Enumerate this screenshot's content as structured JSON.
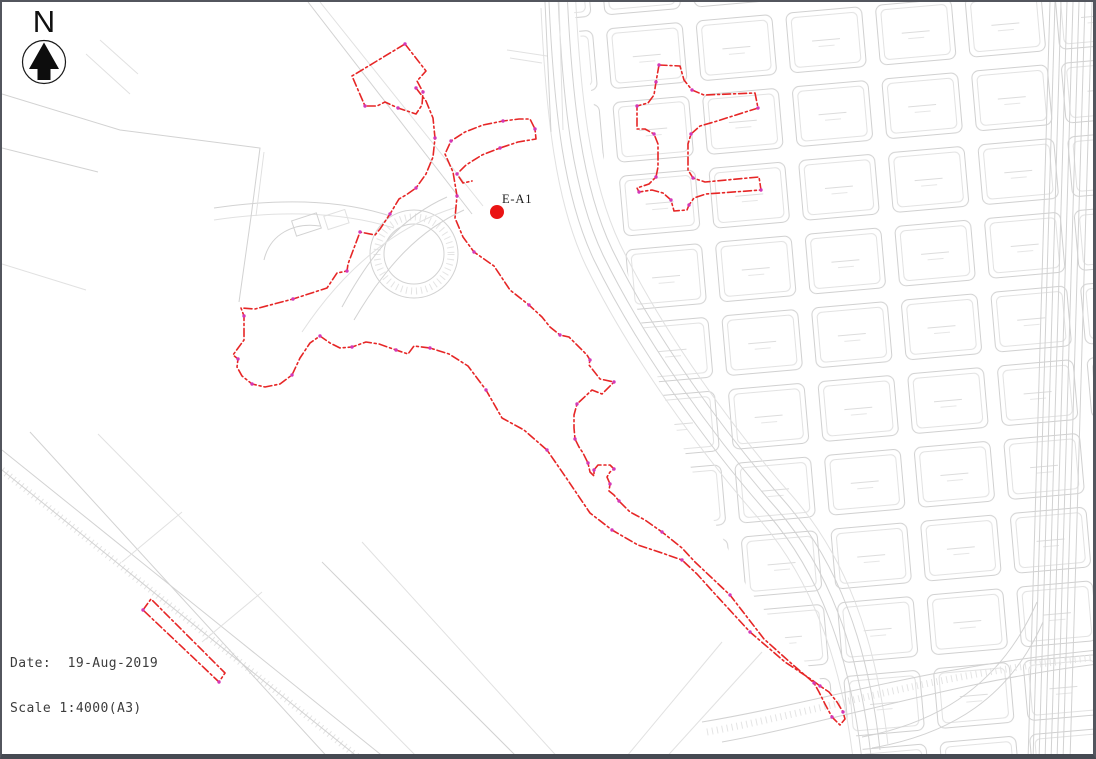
{
  "north_arrow": {
    "label": "N"
  },
  "site_marker": {
    "label": "E-A1",
    "x": 495,
    "y": 210,
    "radius": 7,
    "label_x": 500,
    "label_y": 201
  },
  "title_block": {
    "date_label": "Date:",
    "date_value": "19-Aug-2019",
    "scale_label": "Scale",
    "scale_value": "1:4000(A3)"
  },
  "colors": {
    "boundary_red": "#e62626",
    "node_magenta": "#d338b8",
    "marker_red": "#ea1414",
    "linework_gray": "#d2d2d2",
    "frame_dark": "#4b4f57"
  },
  "boundary": {
    "style": "dash-dot survey boundary with station nodes",
    "shapes": [
      {
        "name": "boundary-north-parcel",
        "closed": true,
        "points": [
          [
            403,
            42
          ],
          [
            424,
            69
          ],
          [
            415,
            79
          ],
          [
            421,
            90
          ],
          [
            420,
            103
          ],
          [
            414,
            112
          ],
          [
            396,
            106
          ],
          [
            383,
            100
          ],
          [
            375,
            104
          ],
          [
            363,
            104
          ],
          [
            350,
            74
          ]
        ]
      },
      {
        "name": "boundary-main-loop",
        "closed": false,
        "points": [
          [
            414,
            86
          ],
          [
            424,
            99
          ],
          [
            431,
            116
          ],
          [
            433,
            136
          ],
          [
            431,
            155
          ],
          [
            424,
            172
          ],
          [
            414,
            186
          ],
          [
            404,
            193
          ],
          [
            397,
            197
          ],
          [
            388,
            212
          ],
          [
            378,
            227
          ],
          [
            373,
            233
          ],
          [
            358,
            230
          ],
          [
            352,
            246
          ],
          [
            346,
            262
          ],
          [
            345,
            269
          ],
          [
            335,
            271
          ],
          [
            325,
            286
          ],
          [
            291,
            297
          ],
          [
            253,
            307
          ],
          [
            239,
            306
          ],
          [
            242,
            314
          ],
          [
            242,
            338
          ],
          [
            231,
            353
          ],
          [
            236,
            357
          ],
          [
            235,
            365
          ],
          [
            240,
            374
          ],
          [
            250,
            382
          ],
          [
            263,
            385
          ],
          [
            278,
            382
          ],
          [
            290,
            373
          ],
          [
            298,
            356
          ],
          [
            308,
            341
          ],
          [
            318,
            334
          ],
          [
            328,
            341
          ],
          [
            338,
            346
          ],
          [
            350,
            345
          ],
          [
            364,
            340
          ],
          [
            377,
            342
          ],
          [
            394,
            348
          ],
          [
            406,
            352
          ],
          [
            412,
            344
          ],
          [
            428,
            346
          ],
          [
            447,
            352
          ],
          [
            466,
            364
          ],
          [
            484,
            388
          ],
          [
            500,
            416
          ],
          [
            522,
            428
          ],
          [
            545,
            448
          ],
          [
            565,
            477
          ],
          [
            588,
            511
          ],
          [
            610,
            528
          ],
          [
            636,
            543
          ],
          [
            660,
            551
          ],
          [
            680,
            558
          ],
          [
            695,
            572
          ],
          [
            713,
            592
          ],
          [
            748,
            630
          ],
          [
            783,
            660
          ],
          [
            810,
            678
          ],
          [
            818,
            684
          ],
          [
            827,
            690
          ],
          [
            835,
            700
          ],
          [
            841,
            710
          ],
          [
            843,
            717
          ],
          [
            838,
            723
          ],
          [
            830,
            715
          ],
          [
            823,
            702
          ],
          [
            817,
            690
          ],
          [
            812,
            681
          ],
          [
            790,
            662
          ],
          [
            762,
            637
          ],
          [
            728,
            593
          ],
          [
            693,
            560
          ],
          [
            680,
            546
          ],
          [
            660,
            530
          ],
          [
            643,
            518
          ],
          [
            628,
            510
          ],
          [
            617,
            499
          ],
          [
            612,
            493
          ],
          [
            607,
            489
          ],
          [
            608,
            482
          ],
          [
            605,
            475
          ],
          [
            608,
            470
          ],
          [
            612,
            467
          ],
          [
            608,
            463
          ],
          [
            596,
            463
          ],
          [
            592,
            468
          ],
          [
            592,
            474
          ],
          [
            588,
            470
          ],
          [
            586,
            461
          ],
          [
            581,
            451
          ],
          [
            577,
            445
          ],
          [
            573,
            437
          ],
          [
            572,
            426
          ],
          [
            572,
            413
          ],
          [
            575,
            402
          ],
          [
            590,
            388
          ],
          [
            600,
            392
          ],
          [
            612,
            380
          ],
          [
            598,
            377
          ],
          [
            587,
            363
          ],
          [
            588,
            358
          ],
          [
            585,
            353
          ],
          [
            567,
            335
          ],
          [
            558,
            333
          ],
          [
            548,
            325
          ],
          [
            540,
            315
          ],
          [
            527,
            303
          ],
          [
            508,
            288
          ],
          [
            492,
            264
          ],
          [
            472,
            250
          ],
          [
            461,
            235
          ],
          [
            453,
            216
          ],
          [
            455,
            194
          ],
          [
            451,
            170
          ],
          [
            443,
            152
          ],
          [
            449,
            139
          ],
          [
            463,
            130
          ],
          [
            481,
            123
          ],
          [
            501,
            119
          ],
          [
            517,
            117
          ],
          [
            528,
            117
          ],
          [
            533,
            127
          ],
          [
            534,
            137
          ],
          [
            516,
            140
          ],
          [
            498,
            146
          ],
          [
            480,
            153
          ],
          [
            464,
            163
          ],
          [
            455,
            172
          ],
          [
            461,
            181
          ],
          [
            470,
            179
          ]
        ]
      },
      {
        "name": "boundary-northeast-cross",
        "closed": true,
        "points": [
          [
            657,
            63
          ],
          [
            678,
            64
          ],
          [
            682,
            78
          ],
          [
            690,
            88
          ],
          [
            702,
            93
          ],
          [
            753,
            91
          ],
          [
            756,
            106
          ],
          [
            712,
            120
          ],
          [
            698,
            124
          ],
          [
            689,
            132
          ],
          [
            686,
            142
          ],
          [
            686,
            168
          ],
          [
            691,
            176
          ],
          [
            703,
            180
          ],
          [
            757,
            175
          ],
          [
            759,
            188
          ],
          [
            704,
            192
          ],
          [
            692,
            196
          ],
          [
            687,
            203
          ],
          [
            685,
            208
          ],
          [
            672,
            209
          ],
          [
            669,
            198
          ],
          [
            661,
            191
          ],
          [
            650,
            188
          ],
          [
            637,
            190
          ],
          [
            635,
            186
          ],
          [
            647,
            182
          ],
          [
            654,
            175
          ],
          [
            656,
            165
          ],
          [
            656,
            142
          ],
          [
            652,
            132
          ],
          [
            643,
            127
          ],
          [
            635,
            127
          ],
          [
            635,
            104
          ],
          [
            646,
            101
          ],
          [
            652,
            93
          ],
          [
            654,
            80
          ]
        ]
      },
      {
        "name": "boundary-southwest-strip",
        "closed": true,
        "points": [
          [
            141,
            608
          ],
          [
            149,
            597
          ],
          [
            223,
            671
          ],
          [
            217,
            680
          ]
        ]
      }
    ]
  }
}
